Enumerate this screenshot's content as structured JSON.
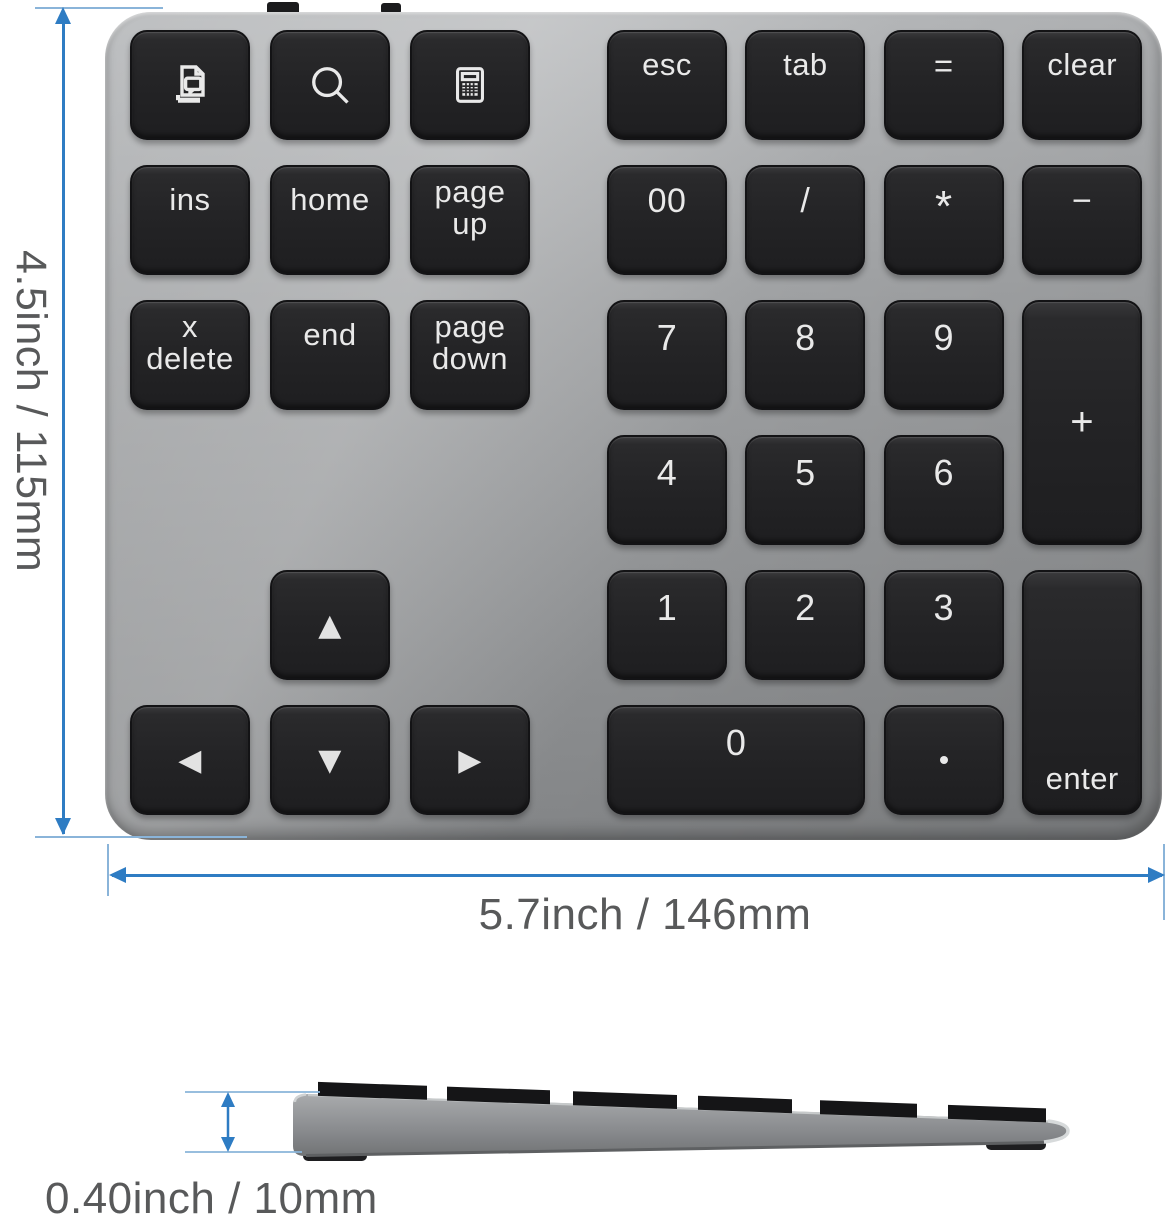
{
  "annotations": {
    "height_label": "4.5inch / 115mm",
    "width_label": "5.7inch / 146mm",
    "thickness_label": "0.40inch / 10mm",
    "dim_line_color": "#2e7cc3",
    "ext_line_color": "#8ab4d9",
    "label_text_color": "#58595a"
  },
  "keypad": {
    "body_color_top": "#b7b9bb",
    "body_color_bottom": "#86888a",
    "key_color": "#242426",
    "key_text_color": "#e9e9e9",
    "top_edge_tabs": 2,
    "keys": [
      {
        "name": "key-screen-doc",
        "cluster": "left",
        "col": 1,
        "row": 1,
        "icon": "print-doc-icon"
      },
      {
        "name": "key-search",
        "cluster": "left",
        "col": 2,
        "row": 1,
        "icon": "search-icon"
      },
      {
        "name": "key-calculator",
        "cluster": "left",
        "col": 3,
        "row": 1,
        "icon": "calculator-icon"
      },
      {
        "name": "key-ins",
        "cluster": "left",
        "col": 1,
        "row": 2,
        "label": "ins"
      },
      {
        "name": "key-home",
        "cluster": "left",
        "col": 2,
        "row": 2,
        "label": "home"
      },
      {
        "name": "key-page-up",
        "cluster": "left",
        "col": 3,
        "row": 2,
        "lines": [
          "page",
          "up"
        ]
      },
      {
        "name": "key-x-delete",
        "cluster": "left",
        "col": 1,
        "row": 3,
        "lines": [
          "x",
          "delete"
        ]
      },
      {
        "name": "key-end",
        "cluster": "left",
        "col": 2,
        "row": 3,
        "label": "end"
      },
      {
        "name": "key-page-down",
        "cluster": "left",
        "col": 3,
        "row": 3,
        "lines": [
          "page",
          "down"
        ]
      },
      {
        "name": "key-arrow-up",
        "cluster": "left",
        "col": 2,
        "row": 5,
        "glyph": "▲",
        "valign": "center",
        "size": 30
      },
      {
        "name": "key-arrow-left",
        "cluster": "left",
        "col": 1,
        "row": 6,
        "glyph": "◀",
        "valign": "center",
        "size": 30
      },
      {
        "name": "key-arrow-down",
        "cluster": "left",
        "col": 2,
        "row": 6,
        "glyph": "▼",
        "valign": "center",
        "size": 30
      },
      {
        "name": "key-arrow-right",
        "cluster": "left",
        "col": 3,
        "row": 6,
        "glyph": "▶",
        "valign": "center",
        "size": 30
      },
      {
        "name": "key-esc",
        "cluster": "right",
        "col": 1,
        "row": 1,
        "label": "esc"
      },
      {
        "name": "key-tab",
        "cluster": "right",
        "col": 2,
        "row": 1,
        "label": "tab"
      },
      {
        "name": "key-equals",
        "cluster": "right",
        "col": 3,
        "row": 1,
        "label": "=",
        "size": 33
      },
      {
        "name": "key-clear",
        "cluster": "right",
        "col": 4,
        "row": 1,
        "label": "clear"
      },
      {
        "name": "key-00",
        "cluster": "right",
        "col": 1,
        "row": 2,
        "label": "00",
        "size": 34
      },
      {
        "name": "key-divide",
        "cluster": "right",
        "col": 2,
        "row": 2,
        "label": "/",
        "size": 34
      },
      {
        "name": "key-multiply",
        "cluster": "right",
        "col": 3,
        "row": 2,
        "label": "*",
        "size": 44
      },
      {
        "name": "key-minus",
        "cluster": "right",
        "col": 4,
        "row": 2,
        "label": "−",
        "size": 34
      },
      {
        "name": "key-7",
        "cluster": "right",
        "col": 1,
        "row": 3,
        "label": "7",
        "size": 36
      },
      {
        "name": "key-8",
        "cluster": "right",
        "col": 2,
        "row": 3,
        "label": "8",
        "size": 36
      },
      {
        "name": "key-9",
        "cluster": "right",
        "col": 3,
        "row": 3,
        "label": "9",
        "size": 36
      },
      {
        "name": "key-plus",
        "cluster": "right",
        "col": 4,
        "row": 3,
        "rowspan": 2,
        "label": "+",
        "valign": "center",
        "size": 40
      },
      {
        "name": "key-4",
        "cluster": "right",
        "col": 1,
        "row": 4,
        "label": "4",
        "size": 36
      },
      {
        "name": "key-5",
        "cluster": "right",
        "col": 2,
        "row": 4,
        "label": "5",
        "size": 36
      },
      {
        "name": "key-6",
        "cluster": "right",
        "col": 3,
        "row": 4,
        "label": "6",
        "size": 36
      },
      {
        "name": "key-1",
        "cluster": "right",
        "col": 1,
        "row": 5,
        "label": "1",
        "size": 36
      },
      {
        "name": "key-2",
        "cluster": "right",
        "col": 2,
        "row": 5,
        "label": "2",
        "size": 36
      },
      {
        "name": "key-3",
        "cluster": "right",
        "col": 3,
        "row": 5,
        "label": "3",
        "size": 36
      },
      {
        "name": "key-enter",
        "cluster": "right",
        "col": 4,
        "row": 5,
        "rowspan": 2,
        "label": "enter",
        "valign": "bottom"
      },
      {
        "name": "key-0",
        "cluster": "right",
        "col": 1,
        "row": 6,
        "colspan": 2,
        "label": "0",
        "size": 36
      },
      {
        "name": "key-decimal",
        "cluster": "right",
        "col": 3,
        "row": 6,
        "dot": true,
        "valign": "center"
      }
    ]
  },
  "side_view": {
    "key_slab_count": 6
  }
}
